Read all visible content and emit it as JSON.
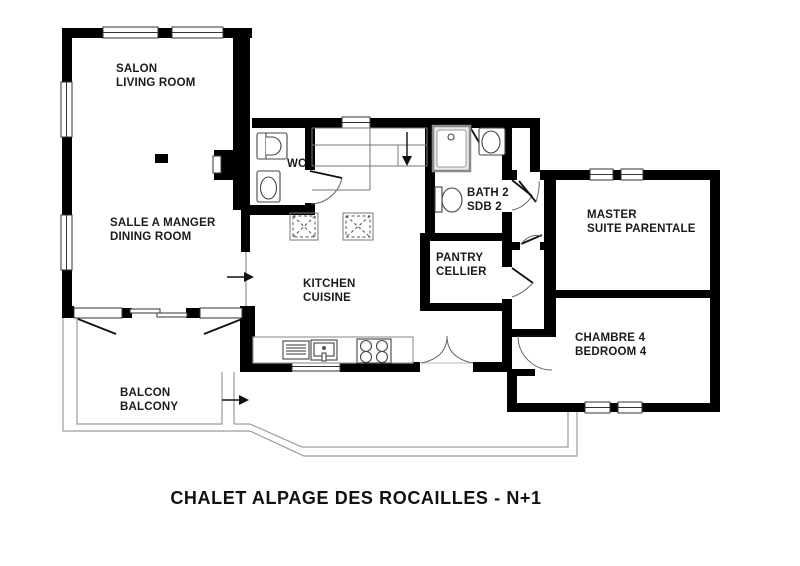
{
  "title": {
    "text": "CHALET ALPAGE DES ROCAILLES -  N+1"
  },
  "rooms": {
    "salon": {
      "line1": "SALON",
      "line2": "LIVING ROOM"
    },
    "dining": {
      "line1": "SALLE A MANGER",
      "line2": "DINING ROOM"
    },
    "wc": {
      "line1": "WC"
    },
    "kitchen": {
      "line1": "KITCHEN",
      "line2": "CUISINE"
    },
    "bath2": {
      "line1": "BATH 2",
      "line2": "SDB 2"
    },
    "pantry": {
      "line1": "PANTRY",
      "line2": "CELLIER"
    },
    "master": {
      "line1": "MASTER",
      "line2": "SUITE PARENTALE"
    },
    "bedroom4": {
      "line1": "CHAMBRE 4",
      "line2": "BEDROOM 4"
    },
    "balcony": {
      "line1": "BALCON",
      "line2": "BALCONY"
    }
  },
  "icons": {
    "stairs_direction": "down-arrow",
    "dining_passage": "right-arrow",
    "balcony_passage": "right-arrow"
  },
  "colors": {
    "wall": "#000000",
    "fixture_line": "#444444",
    "thin_line": "#777777",
    "walkway_line": "#9a9a9a",
    "text": "#1b1b1b",
    "background": "#ffffff"
  }
}
